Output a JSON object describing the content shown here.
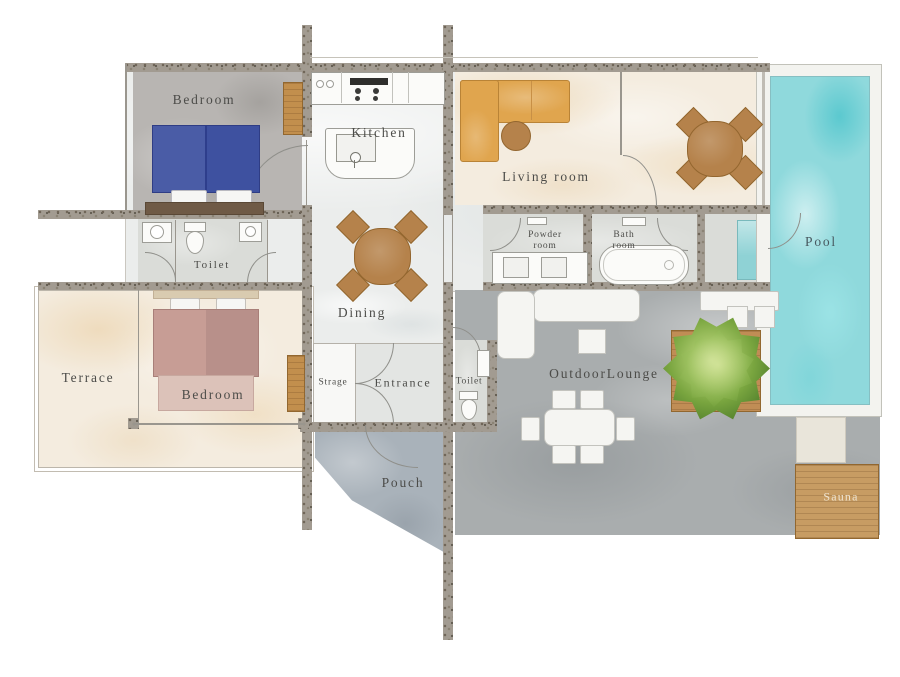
{
  "type": "residential-floor-plan",
  "rooms": {
    "bedroom_upper": {
      "label": "Bedroom"
    },
    "kitchen": {
      "label": "Kitchen"
    },
    "living_room": {
      "label": "Living room"
    },
    "pool": {
      "label": "Pool"
    },
    "toilet_upper": {
      "label": "Toilet"
    },
    "powder_room": {
      "line1": "Powder",
      "line2": "room"
    },
    "bath_room": {
      "line1": "Bath",
      "line2": "room"
    },
    "dining": {
      "label": "Dining"
    },
    "terrace": {
      "label": "Terrace"
    },
    "bedroom_lower": {
      "label": "Bedroom"
    },
    "storage": {
      "label": "Strage"
    },
    "entrance": {
      "label": "Entrance"
    },
    "toilet_lower": {
      "label": "Toilet"
    },
    "outdoor_lounge": {
      "label": "OutdoorLounge"
    },
    "porch": {
      "label": "Pouch"
    },
    "sauna": {
      "label": "Sauna"
    }
  },
  "colors": {
    "wall": "#a29b91",
    "beige": "#f4ecdf",
    "concrete": "#a9adae",
    "pool_water": "#8fd9dc",
    "wood": "#b5824b",
    "sofa": "#e0a54e",
    "bed_blue": "#3e51a0",
    "bed_pink": "#c79d95",
    "tree_green": "#6f9c3c"
  }
}
